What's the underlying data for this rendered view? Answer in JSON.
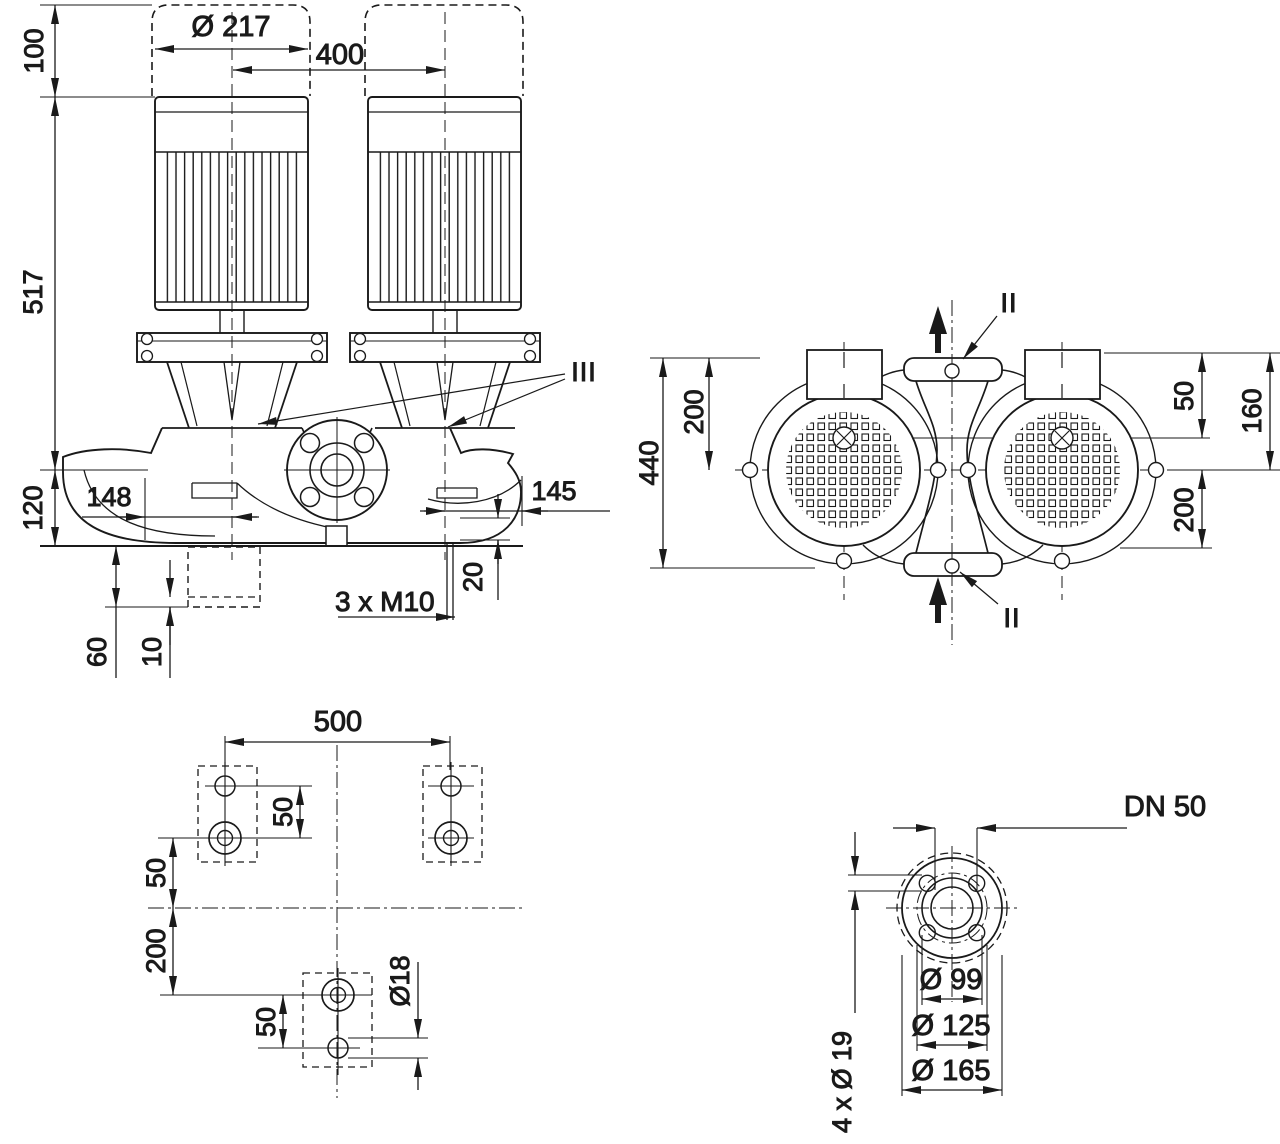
{
  "front": {
    "clearance": "100",
    "fan_dia": "Ø 217",
    "spacing": "400",
    "height": "517",
    "port_height": "120",
    "left_offset": "148",
    "right_offset": "145",
    "drain_offset": "20",
    "tapping": "3 x M10",
    "foundation_depth": "60",
    "grout": "10",
    "section_mark": "III"
  },
  "top": {
    "width_overall": "440",
    "left_depth": "200",
    "motor_offset": "50",
    "port_depth": "160",
    "right_depth": "200",
    "section_top": "II",
    "section_bottom": "II"
  },
  "foundation": {
    "bolt_span": "500",
    "pitch_top": "50",
    "row_offset": "50",
    "center_offset": "200",
    "pitch_bottom": "50",
    "hole_dia": "Ø18"
  },
  "flange": {
    "nominal": "DN 50",
    "raised_face": "Ø 99",
    "bolt_circle": "Ø 125",
    "outer_dia": "Ø 165",
    "bolt_holes": "4 x Ø 19"
  }
}
